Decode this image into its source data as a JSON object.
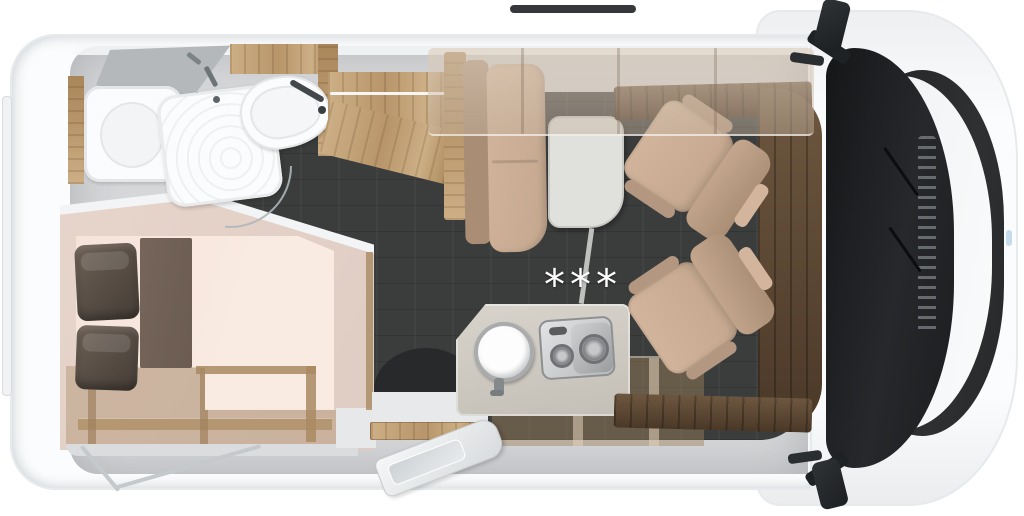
{
  "scene": {
    "description": "motorhome floor plan, top-down cutaway render, cab at right and rear bedroom at left"
  },
  "annotations": {
    "kitchen_note": "***"
  },
  "palette": {
    "body": "#fbfcfd",
    "body_shade": "#e7eaec",
    "interior": "#d6d7d9",
    "floor": "#3b3d3c",
    "wood": "#b8956a",
    "wood_hi": "#cdaf85",
    "walnut": "#64503a",
    "walnut_deep": "#4a3827",
    "uph": "#c4a78e",
    "uph_hi": "#d2b59c",
    "uph_deep": "#a98d75",
    "mattress": "#f6e4db",
    "bed_base": "#e7d5cc",
    "runner": "#6b5c52",
    "pillow": "#564c44",
    "fixture": "#fbfcfd",
    "fixture_line": "#e4e6e7",
    "counter": "#c3bfb7",
    "steel": "#b7b9bb",
    "steel_deep": "#8d8f91",
    "glass": "#26282b",
    "grille": "#2e3032",
    "mirror": "#212426",
    "table": "#e0e1dd",
    "door_mat": "#28292b",
    "storage": "rgba(180,152,120,0.5)",
    "note": "#ffffff"
  }
}
